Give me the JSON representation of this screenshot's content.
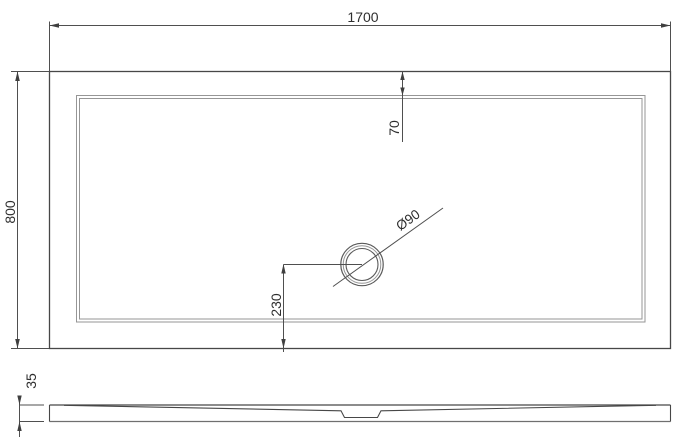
{
  "drawing": {
    "kind": "shower-tray-technical-drawing",
    "views": {
      "plan": {
        "dim_width": "1700",
        "dim_depth": "800",
        "dim_rim_top_offset": "70",
        "dim_drain_offset_bottom": "230",
        "dim_drain_diameter": "Ø90"
      },
      "side": {
        "dim_height": "35"
      }
    },
    "colors": {
      "background": "#ffffff",
      "line_dark": "#474747",
      "line_light": "#969696",
      "text": "#2e2e2e"
    }
  }
}
